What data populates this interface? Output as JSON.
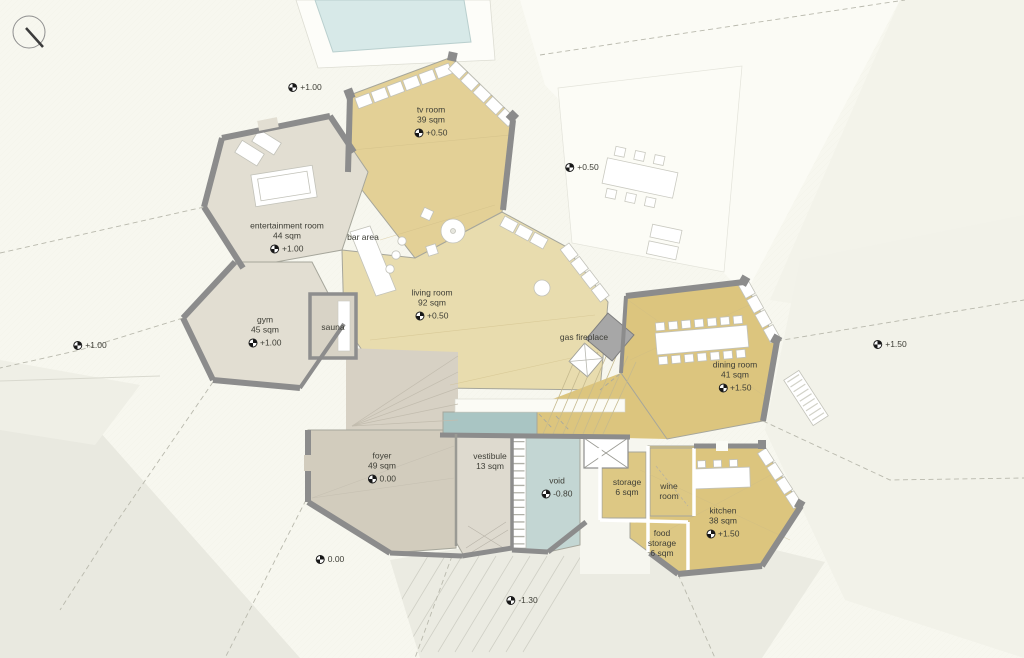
{
  "drawing": {
    "type": "architectural floor plan",
    "north_arrow": "north-arrow"
  },
  "rooms": {
    "tv_room": {
      "name": "tv room",
      "area": "39 sqm",
      "elevation": "+0.50"
    },
    "entertainment": {
      "name": "entertainment room",
      "area": "44 sqm",
      "elevation": "+1.00"
    },
    "gym": {
      "name": "gym",
      "area": "45 sqm",
      "elevation": "+1.00"
    },
    "living": {
      "name": "living room",
      "area": "92 sqm",
      "elevation": "+0.50"
    },
    "dining": {
      "name": "dining room",
      "area": "41 sqm",
      "elevation": "+1.50"
    },
    "kitchen": {
      "name": "kitchen",
      "area": "38 sqm",
      "elevation": "+1.50"
    },
    "foyer": {
      "name": "foyer",
      "area": "49 sqm",
      "elevation": "0.00"
    },
    "vestibule": {
      "name": "vestibule",
      "area": "13 sqm"
    },
    "void": {
      "name": "void",
      "elevation": "-0.80"
    },
    "storage": {
      "name": "storage",
      "area": "6 sqm"
    },
    "wine": {
      "name": "wine room"
    },
    "food_storage": {
      "name": "food storage",
      "area": "6 sqm"
    }
  },
  "annotations": {
    "sauna": "sauna",
    "bar_area": "bar area",
    "gas_fireplace": "gas fireplace"
  },
  "site_levels": {
    "nw": "+1.00",
    "ne": "+0.50",
    "e": "+1.50",
    "w": "+1.00",
    "sw": "0.00",
    "s": "-1.30"
  },
  "colors": {
    "background": "#f7f7ef",
    "floor_warm_yellow": "#e3d096",
    "floor_accent_yellow": "#dcc57e",
    "floor_living_tan": "#e8dcae",
    "floor_neutral_grey": "#e2ded2",
    "floor_foyer": "#d2ccbd",
    "water_channel": "#a9c5c3",
    "void_floor": "#c3d6d3",
    "pool": "#d7e9e8",
    "wall_grey": "#8c8c8c"
  }
}
